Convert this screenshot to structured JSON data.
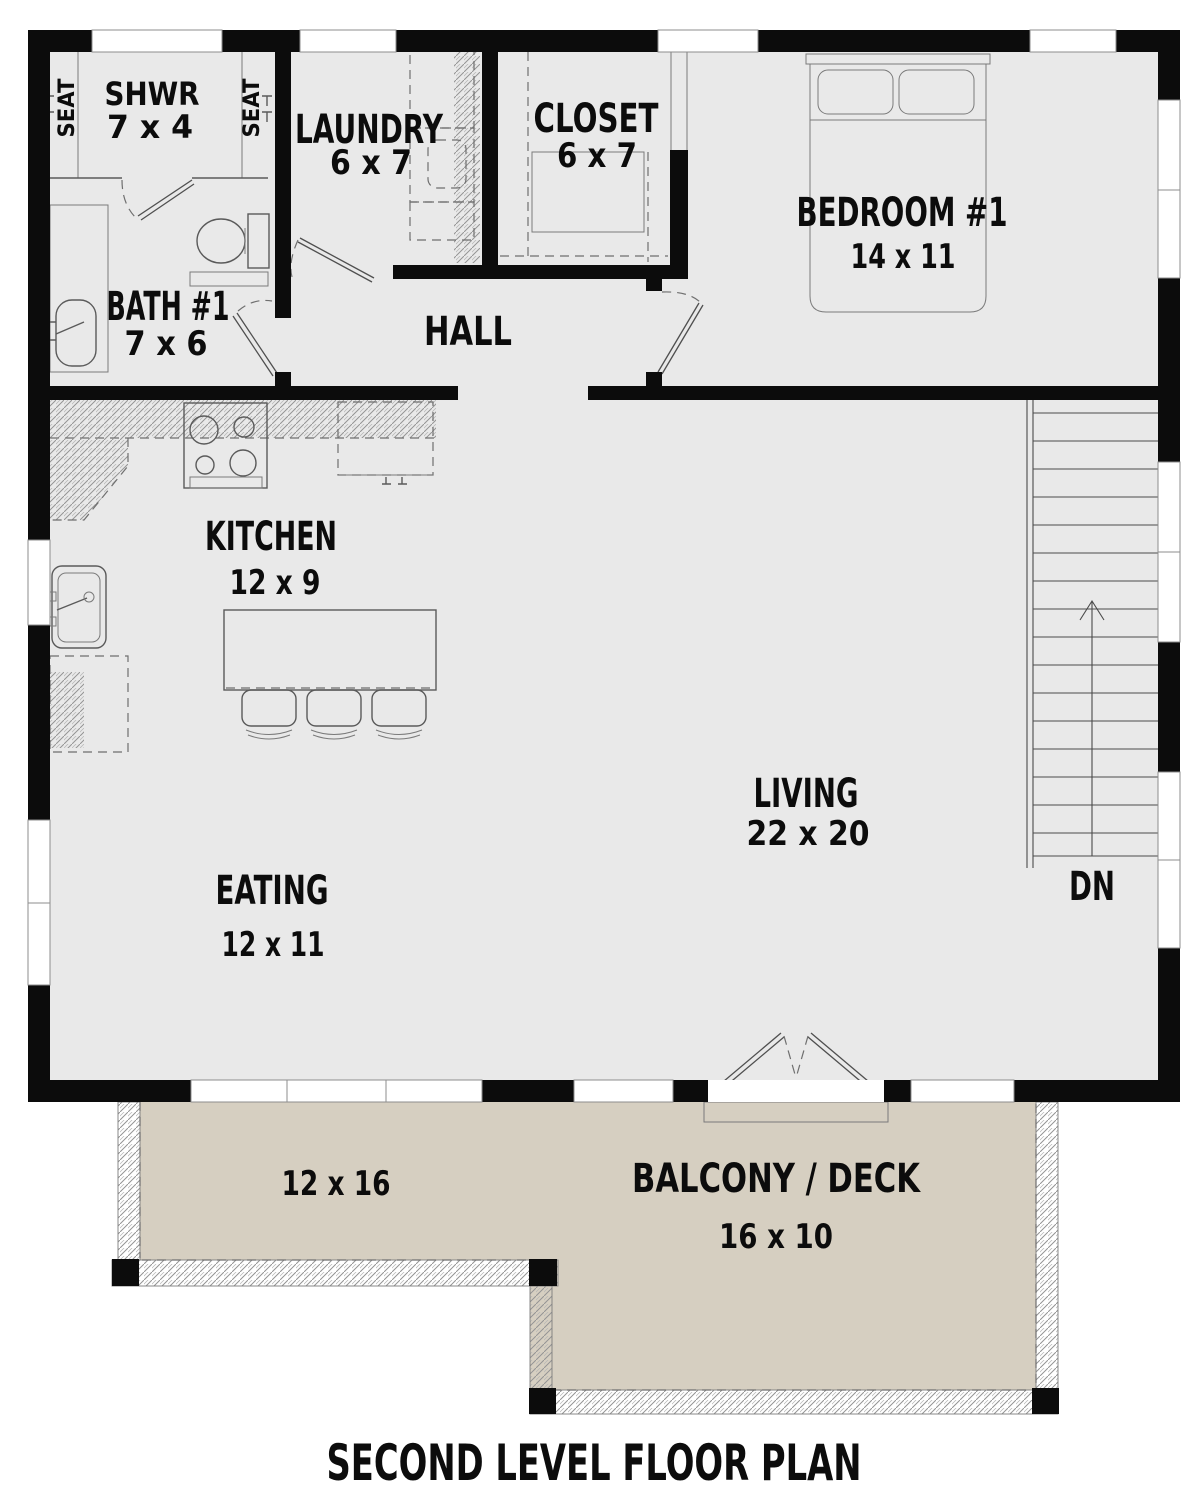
{
  "plan": {
    "title": "SECOND LEVEL FLOOR PLAN",
    "stairs_label": "DN",
    "seat_label": "SEAT",
    "balcony_left_dims": "12 x 16",
    "rooms": [
      {
        "id": "shwr",
        "name": "SHWR",
        "dims": "7 x 4"
      },
      {
        "id": "laundry",
        "name": "LAUNDRY",
        "dims": "6 x 7"
      },
      {
        "id": "closet",
        "name": "CLOSET",
        "dims": "6 x 7"
      },
      {
        "id": "bedroom1",
        "name": "BEDROOM #1",
        "dims": "14 x 11"
      },
      {
        "id": "bath1",
        "name": "BATH #1",
        "dims": "7 x 6"
      },
      {
        "id": "hall",
        "name": "HALL",
        "dims": ""
      },
      {
        "id": "kitchen",
        "name": "KITCHEN",
        "dims": "12 x 9"
      },
      {
        "id": "living",
        "name": "LIVING",
        "dims": "22 x 20"
      },
      {
        "id": "eating",
        "name": "EATING",
        "dims": "12 x 11"
      },
      {
        "id": "balcony",
        "name": "BALCONY / DECK",
        "dims": "16 x 10"
      }
    ],
    "colors": {
      "floor": "#e9e9e9",
      "balcony_floor": "#d6cfc1",
      "wall": "#0c0c0c",
      "fixture_line": "#5a5a5a"
    }
  }
}
